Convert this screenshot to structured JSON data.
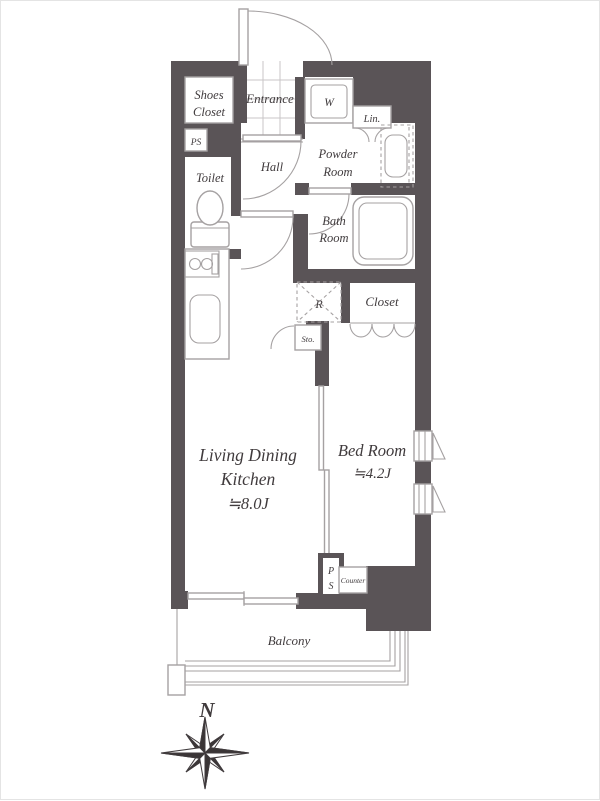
{
  "title": "1K apartment floor plan",
  "colors": {
    "wall": "#5a5457",
    "fixture_line": "#a5a1a2",
    "tile_line": "#c9c6c7",
    "text": "#403b3d",
    "background": "#ffffff",
    "frame": "#e4e4e4"
  },
  "rooms": {
    "shoes_closet": {
      "label_line1": "Shoes",
      "label_line2": "Closet"
    },
    "entrance": {
      "label": "Entrance"
    },
    "pipe_space_upper": {
      "label": "PS"
    },
    "toilet": {
      "label": "Toilet"
    },
    "hall": {
      "label": "Hall"
    },
    "washer": {
      "label": "W"
    },
    "linen": {
      "label": "Lin."
    },
    "powder_room": {
      "label_line1": "Powder",
      "label_line2": "Room"
    },
    "bath_room": {
      "label_line1": "Bath",
      "label_line2": "Room"
    },
    "refrigerator": {
      "label": "R"
    },
    "closet": {
      "label": "Closet"
    },
    "storage": {
      "label": "Sto."
    },
    "ldk": {
      "label_line1": "Living Dining",
      "label_line2": "Kitchen",
      "size": "≒8.0J"
    },
    "bedroom": {
      "label": "Bed Room",
      "size": "≒4.2J"
    },
    "pipe_space_lower": {
      "label_line1": "P",
      "label_line2": "S"
    },
    "counter": {
      "label": "Counter"
    },
    "balcony": {
      "label": "Balcony"
    }
  },
  "compass": {
    "north_label": "N"
  }
}
